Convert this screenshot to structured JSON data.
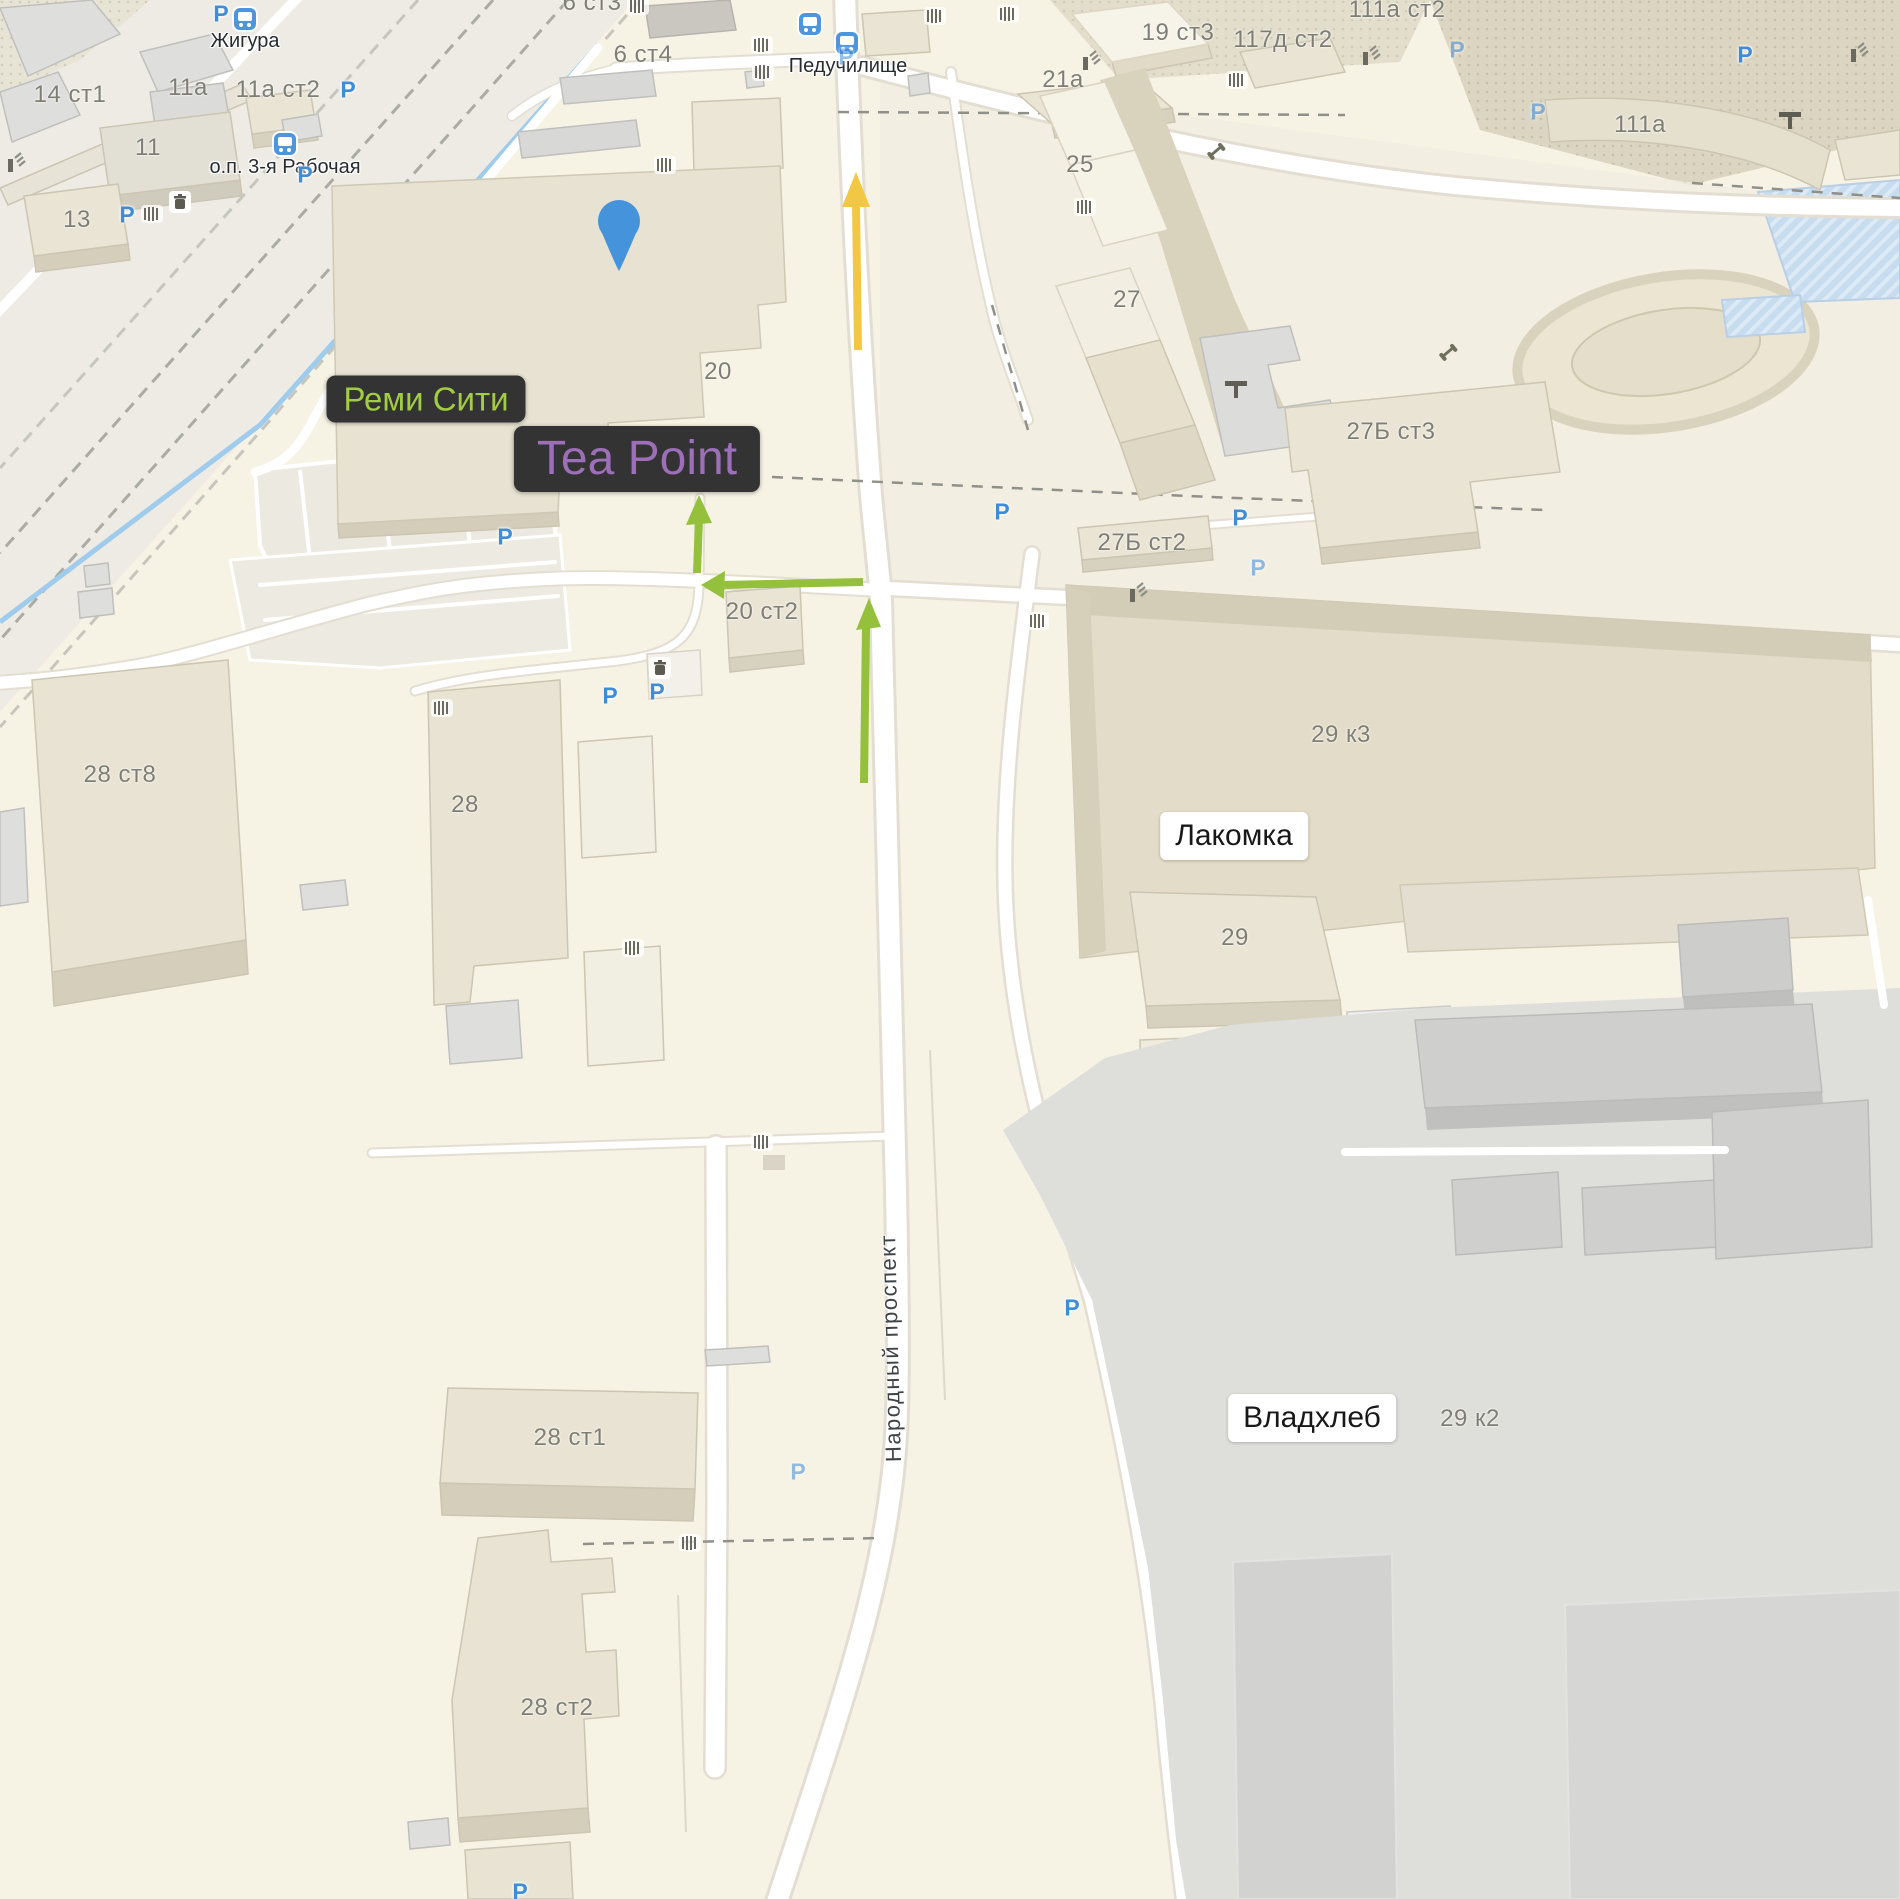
{
  "map": {
    "parking_symbol": "P",
    "street_label": "Народный проспект",
    "poi": {
      "remi_city": "Реми Сити",
      "tea_point": "Tea Point",
      "lakomka": "Лакомка",
      "vladkhleb": "Владхлеб"
    },
    "transit_stops": {
      "zhigura": "Жигура",
      "rabochaya": "о.п. 3-я Рабочая",
      "peduchilishche": "Педучилище"
    },
    "buildings": [
      {
        "label": "14 ст1"
      },
      {
        "label": "11а"
      },
      {
        "label": "11а ст2"
      },
      {
        "label": "11"
      },
      {
        "label": "13"
      },
      {
        "label": "6 ст3"
      },
      {
        "label": "6 ст4"
      },
      {
        "label": "19 ст3"
      },
      {
        "label": "117д ст2"
      },
      {
        "label": "111а ст2"
      },
      {
        "label": "111а"
      },
      {
        "label": "21а"
      },
      {
        "label": "25"
      },
      {
        "label": "27"
      },
      {
        "label": "27Б ст3"
      },
      {
        "label": "27Б ст2"
      },
      {
        "label": "20"
      },
      {
        "label": "20 ст2"
      },
      {
        "label": "28 ст8"
      },
      {
        "label": "28"
      },
      {
        "label": "29 к3"
      },
      {
        "label": "29"
      },
      {
        "label": "28 ст1"
      },
      {
        "label": "28 ст2"
      },
      {
        "label": "29 к2"
      }
    ],
    "route": {
      "pin_color": "#4593DB",
      "walk_arrow_color": "#94C03C",
      "drive_arrow_color": "#F2C743"
    },
    "colors": {
      "background": "#F6F2E4",
      "building_fill": "#E9E4D4",
      "gray_zone": "#DEDEDB",
      "poi_dark_bg": "#333333",
      "remi_city_text": "#A3CC45",
      "tea_point_text": "#9C6FB8",
      "parking_blue": "#3F8DD8",
      "road_white": "#FFFFFF"
    }
  }
}
